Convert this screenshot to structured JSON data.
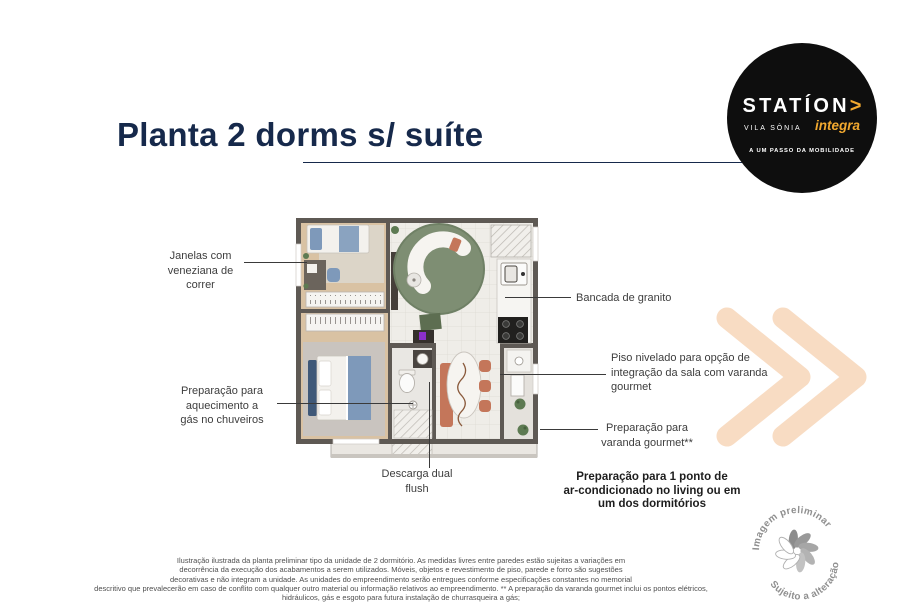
{
  "title": "Planta 2 dorms s/ suíte",
  "logo": {
    "brand": "STATÍON",
    "arrow": ">",
    "location": "VILA SÔNIA",
    "sub_brand": "integra",
    "tagline": "A UM PASSO DA MOBILIDADE"
  },
  "callouts": {
    "janelas": "Janelas com\nveneziana de\ncorrer",
    "aquecimento": "Preparação para\naquecimento a\ngás no chuveiros",
    "bancada": "Bancada de granito",
    "piso": "Piso nivelado para opção de\nintegração da sala com varanda\ngourmet",
    "varanda": "Preparação para\nvaranda gourmet**",
    "descarga": "Descarga dual\nflush",
    "ar_condicionado": "Preparação para 1 ponto de\nar-condicionado no living ou em\num dos dormitórios"
  },
  "stamp": {
    "line1": "Imagem preliminar",
    "line2": "Sujeito a alteração"
  },
  "disclaimer": "Ilustração ilustrada da planta preliminar tipo da unidade de 2 dormitório. As medidas livres entre paredes estão sujeitas a variações em\ndecorrência da execução dos acabamentos a serem utilizados. Móveis, objetos e revestimento de piso, parede e forro são sugestões\ndecorativas e não integram a unidade. As unidades do empreendimento serão entregues conforme especificações constantes no memorial\ndescritivo que prevalecerão em caso de conflito com qualquer outro material ou informação relativos ao empreendimento. ** A preparação da varanda gourmet inclui os pontos elétricos,\nhidráulicos, gás e esgoto para futura instalação de churrasqueira a gás;",
  "colors": {
    "title_navy": "#16294b",
    "chevron_peach": "#f8dcc3",
    "logo_accent": "#f2a92f",
    "logo_bg": "#0e0e0e",
    "wall_gray": "#5e5954"
  }
}
